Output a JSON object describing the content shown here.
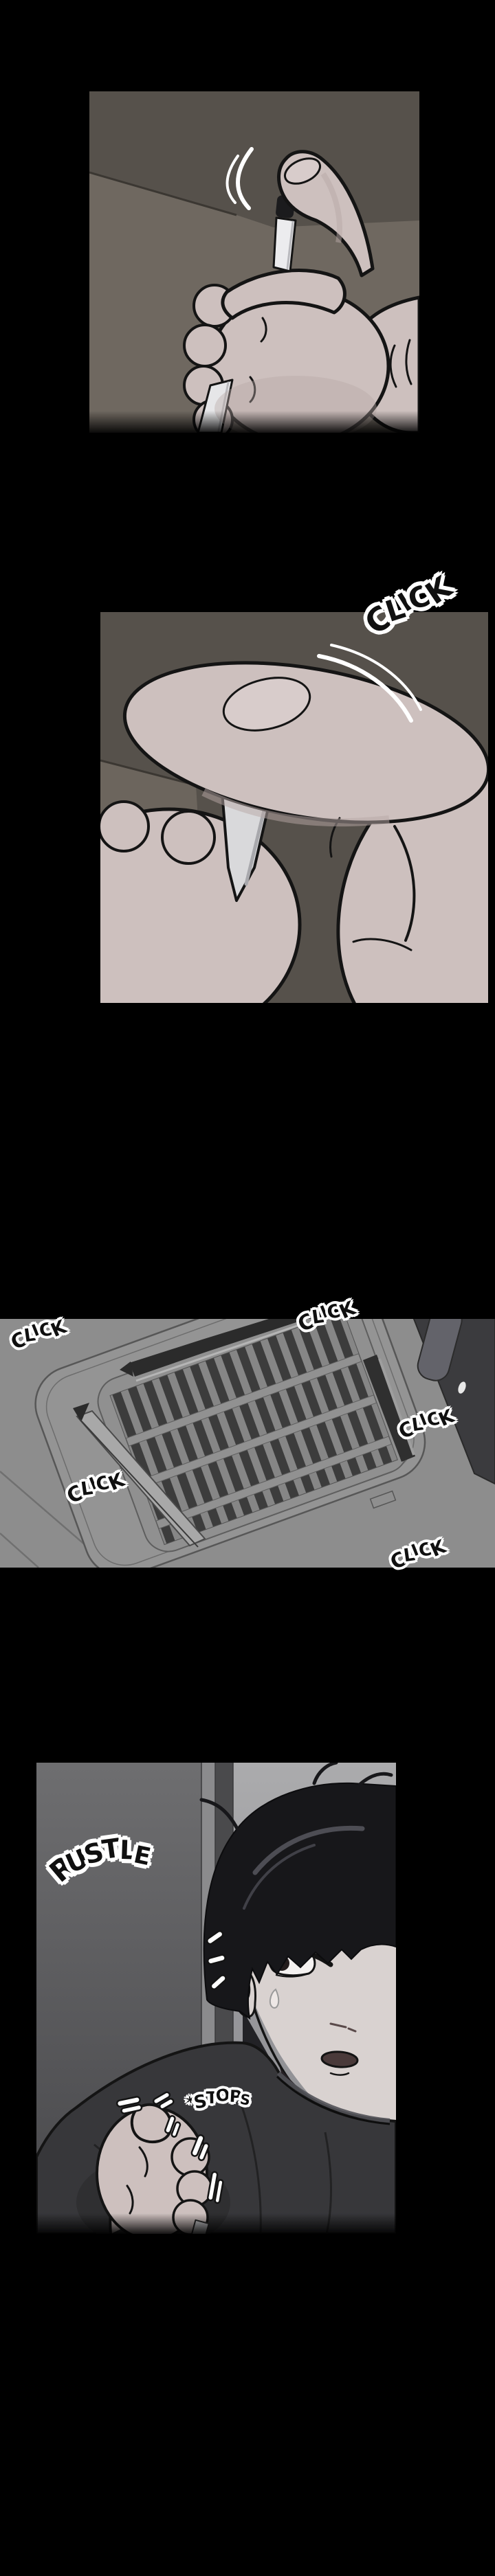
{
  "page": {
    "label": "Webtoon comic episode page",
    "background": "#000000"
  },
  "panels": {
    "panel1": {
      "alt": "A hand raised against a dark ceiling, thumb resting on the black button of a white click pen"
    },
    "panel2": {
      "alt": "Extreme close-up of the thumb pressing down the pen clicker",
      "sfx_click": "CLICK"
    },
    "panel3": {
      "alt": "Gray ceiling seen from below with a cassette air-vent grille and a dark beam, clicking repeatedly",
      "sfx_clicks": [
        "CLICK",
        "CLICK",
        "CLICK",
        "CLICK",
        "CLICK"
      ]
    },
    "panel4": {
      "alt": "Startled dark-haired man in a dark t-shirt, sweating, clutching the click pen in his fist as the sound stops",
      "sfx_rustle": "RUSTLE",
      "sfx_stops": "*STOPS"
    }
  },
  "colors": {
    "page_background": "#000000",
    "sfx_fill": "#101010",
    "sfx_outline": "#ffffff",
    "ceiling_dark": "#56514b",
    "wall_light": "#6f6860",
    "vent_gray": "#8d8d8d",
    "vent_slat": "#3c3c3c",
    "beam_dark": "#3b3b3e",
    "skin": "#cdc0be",
    "hair": "#17171a",
    "shirt": "#37373a",
    "pen_shaft": "#ececee",
    "pen_cap": "#1b1b1d"
  }
}
